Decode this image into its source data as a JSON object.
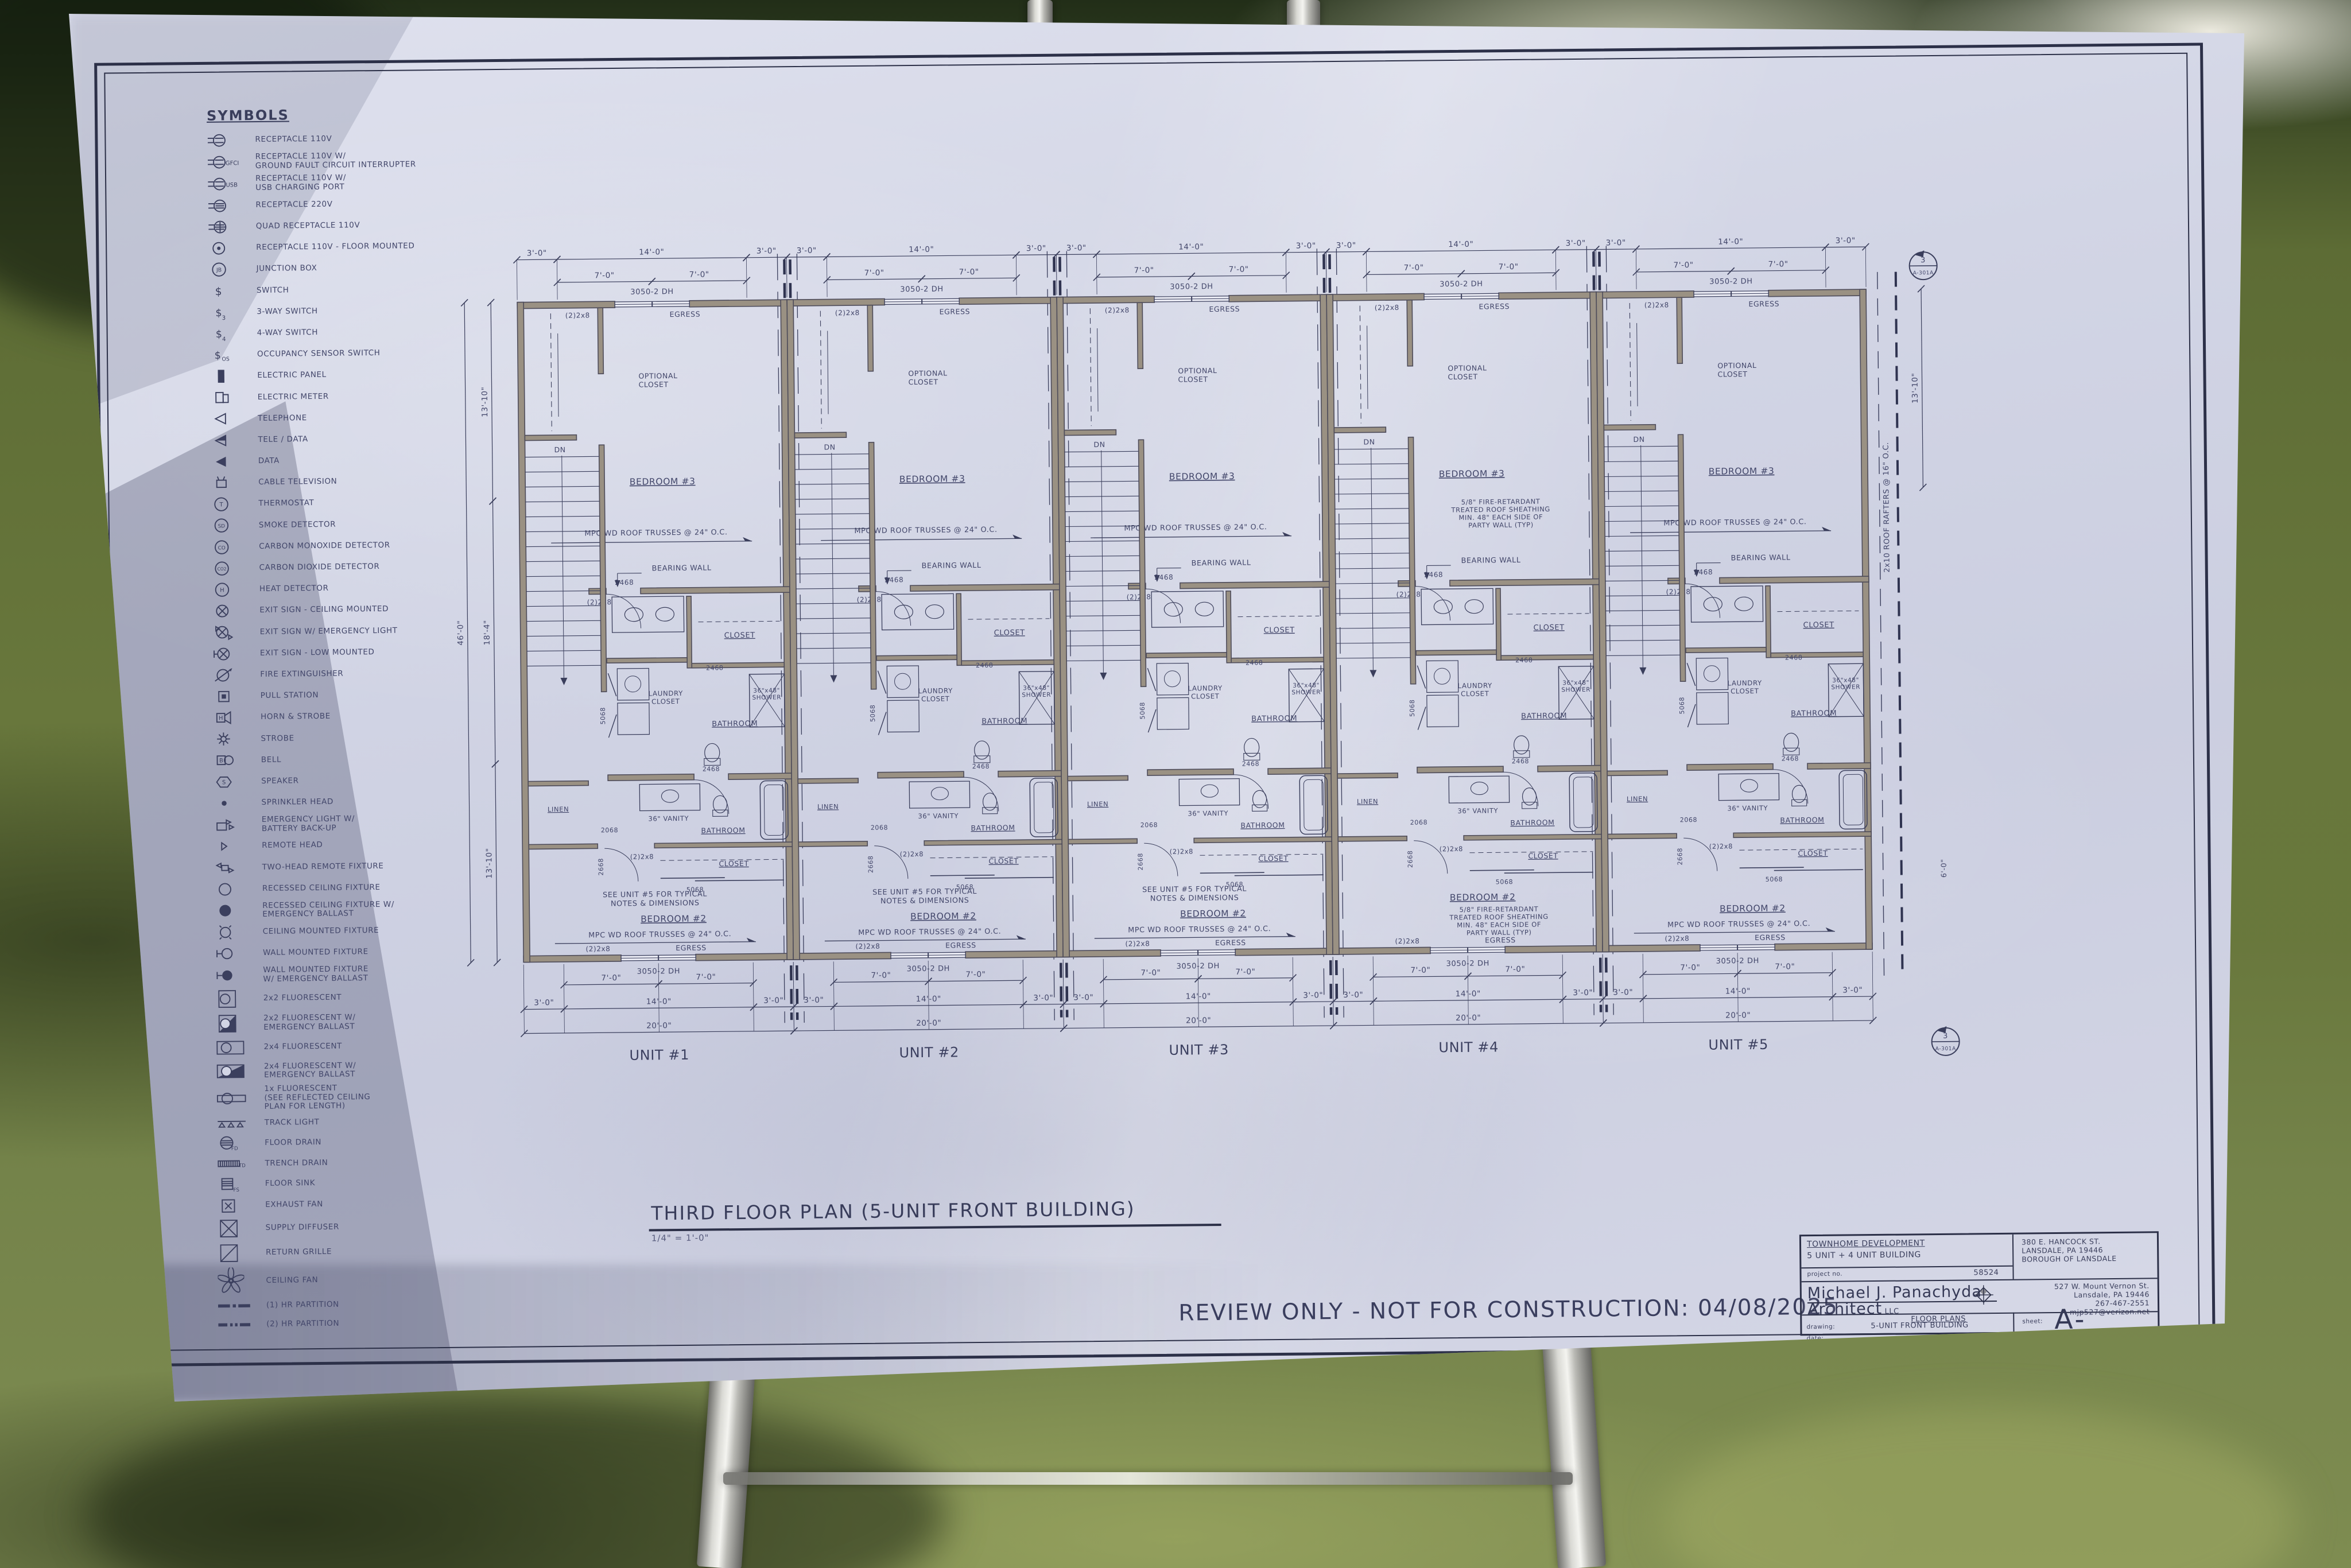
{
  "sheet": {
    "symbols_title": "SYMBOLS",
    "symbols": [
      {
        "icon": "receptacle-110v",
        "label": "RECEPTACLE 110V"
      },
      {
        "icon": "receptacle-gfci",
        "tag": "GFCI",
        "label": "RECEPTACLE 110V W/\nGROUND FAULT CIRCUIT INTERRUPTER"
      },
      {
        "icon": "receptacle-usb",
        "tag": "USB",
        "label": "RECEPTACLE 110V W/\nUSB CHARGING PORT"
      },
      {
        "icon": "receptacle-220v",
        "label": "RECEPTACLE 220V"
      },
      {
        "icon": "quad-receptacle",
        "label": "QUAD RECEPTACLE 110V"
      },
      {
        "icon": "receptacle-floor",
        "label": "RECEPTACLE 110V - FLOOR MOUNTED"
      },
      {
        "icon": "junction-box",
        "tag": "JB",
        "label": "JUNCTION BOX"
      },
      {
        "icon": "switch",
        "tag": "",
        "label": "SWITCH"
      },
      {
        "icon": "switch-3way",
        "tag": "3",
        "label": "3-WAY SWITCH"
      },
      {
        "icon": "switch-4way",
        "tag": "4",
        "label": "4-WAY SWITCH"
      },
      {
        "icon": "switch-occupancy",
        "tag": "OS",
        "label": "OCCUPANCY SENSOR SWITCH"
      },
      {
        "icon": "electric-panel",
        "label": "ELECTRIC PANEL"
      },
      {
        "icon": "electric-meter",
        "label": "ELECTRIC METER"
      },
      {
        "icon": "telephone",
        "label": "TELEPHONE"
      },
      {
        "icon": "tele-data",
        "label": "TELE / DATA"
      },
      {
        "icon": "data",
        "label": "DATA"
      },
      {
        "icon": "cable-television",
        "label": "CABLE TELEVISION"
      },
      {
        "icon": "thermostat",
        "tag": "T",
        "label": "THERMOSTAT"
      },
      {
        "icon": "smoke-detector",
        "tag": "SD",
        "label": "SMOKE DETECTOR"
      },
      {
        "icon": "carbon-monoxide-detector",
        "tag": "CO",
        "label": "CARBON MONOXIDE DETECTOR"
      },
      {
        "icon": "carbon-dioxide-detector",
        "tag": "CO2",
        "label": "CARBON DIOXIDE DETECTOR"
      },
      {
        "icon": "heat-detector",
        "tag": "H",
        "label": "HEAT DETECTOR"
      },
      {
        "icon": "exit-sign-ceiling",
        "label": "EXIT SIGN - CEILING MOUNTED"
      },
      {
        "icon": "exit-sign-emergency-light",
        "label": "EXIT SIGN W/ EMERGENCY LIGHT"
      },
      {
        "icon": "exit-sign-low",
        "label": "EXIT SIGN - LOW MOUNTED"
      },
      {
        "icon": "fire-extinguisher",
        "label": "FIRE EXTINGUISHER"
      },
      {
        "icon": "pull-station",
        "label": "PULL STATION"
      },
      {
        "icon": "horn-strobe",
        "tag": "H",
        "label": "HORN & STROBE"
      },
      {
        "icon": "strobe",
        "label": "STROBE"
      },
      {
        "icon": "bell",
        "tag": "B",
        "label": "BELL"
      },
      {
        "icon": "speaker",
        "tag": "S",
        "label": "SPEAKER"
      },
      {
        "icon": "sprinkler-head",
        "label": "SPRINKLER HEAD"
      },
      {
        "icon": "emergency-light-battery",
        "label": "EMERGENCY LIGHT W/\nBATTERY BACK-UP"
      },
      {
        "icon": "remote-head",
        "label": "REMOTE HEAD"
      },
      {
        "icon": "two-head-remote-fixture",
        "label": "TWO-HEAD REMOTE FIXTURE"
      },
      {
        "icon": "recessed-ceiling-fixture",
        "label": "RECESSED CEILING FIXTURE"
      },
      {
        "icon": "recessed-ceiling-fixture-em",
        "label": "RECESSED CEILING FIXTURE W/\nEMERGENCY BALLAST"
      },
      {
        "icon": "ceiling-mounted-fixture",
        "label": "CEILING MOUNTED FIXTURE"
      },
      {
        "icon": "wall-mounted-fixture",
        "label": "WALL MOUNTED FIXTURE"
      },
      {
        "icon": "wall-mounted-fixture-em",
        "label": "WALL MOUNTED FIXTURE\nW/ EMERGENCY BALLAST"
      },
      {
        "icon": "fluorescent-2x2",
        "label": "2x2 FLUORESCENT"
      },
      {
        "icon": "fluorescent-2x2-em",
        "label": "2x2 FLUORESCENT W/\nEMERGENCY BALLAST"
      },
      {
        "icon": "fluorescent-2x4",
        "label": "2x4 FLUORESCENT"
      },
      {
        "icon": "fluorescent-2x4-em",
        "label": "2x4 FLUORESCENT W/\nEMERGENCY BALLAST"
      },
      {
        "icon": "fluorescent-1x",
        "label": "1x FLUORESCENT\n(SEE REFLECTED CEILING\nPLAN FOR LENGTH)"
      },
      {
        "icon": "track-light",
        "label": "TRACK LIGHT"
      },
      {
        "icon": "floor-drain",
        "tag": "FD",
        "label": "FLOOR DRAIN"
      },
      {
        "icon": "trench-drain",
        "tag": "TD",
        "label": "TRENCH DRAIN"
      },
      {
        "icon": "floor-sink",
        "tag": "FS",
        "label": "FLOOR SINK"
      },
      {
        "icon": "exhaust-fan",
        "label": "EXHAUST FAN"
      },
      {
        "icon": "supply-diffuser",
        "label": "SUPPLY DIFFUSER"
      },
      {
        "icon": "return-grille",
        "label": "RETURN GRILLE"
      },
      {
        "icon": "ceiling-fan",
        "label": "CEILING FAN"
      },
      {
        "icon": "partition-1hr",
        "label": "(1) HR PARTITION"
      },
      {
        "icon": "partition-2hr",
        "label": "(2) HR PARTITION"
      }
    ],
    "plan": {
      "units": [
        "UNIT #1",
        "UNIT #2",
        "UNIT #3",
        "UNIT #4",
        "UNIT #5"
      ],
      "labels": {
        "bedroom3": "BEDROOM #3",
        "bedroom2": "BEDROOM #2",
        "optional_closet": "OPTIONAL\nCLOSET",
        "closet": "CLOSET",
        "laundry": "LAUNDRY\nCLOSET",
        "bathroom": "BATHROOM",
        "linen": "LINEN",
        "shower": "36\"x48\"\nSHOWER",
        "van60": "60\" VAN",
        "vanity36": "36\" VANITY",
        "egress": "EGRESS",
        "window": "3050-2 DH",
        "dn": "DN",
        "d2468": "2468",
        "d2668": "2668",
        "d2068": "2068",
        "d5068": "5068",
        "header": "(2)2x8"
      },
      "notes": {
        "truss": "MPC WD ROOF TRUSSES @ 24\" O.C.",
        "fire": "5/8\" FIRE-RETARDANT\nTREATED ROOF SHEATHING\nMIN. 48\" EACH SIDE OF\nPARTY WALL (TYP)",
        "see5": "SEE UNIT #5 FOR TYPICAL\nNOTES & DIMENSIONS",
        "rafters": "2x10 ROOF RAFTERS @ 16\" O.C.",
        "bearing": "BEARING WALL"
      },
      "dims": {
        "d3": "3'-0\"",
        "d7": "7'-0\"",
        "d14": "14'-0\"",
        "d20": "20'-0\"",
        "d46": "46'-0\"",
        "d18_4": "18'-4\"",
        "d13_10": "13'-10\"",
        "d6": "6'-0\""
      },
      "marker": {
        "num": "3",
        "sheet": "A-301A"
      }
    },
    "plan_title": "THIRD FLOOR PLAN (5-UNIT FRONT BUILDING)",
    "plan_scale": "1/4\" = 1'-0\"",
    "review_note": "REVIEW ONLY - NOT FOR CONSTRUCTION: 04/08/2025",
    "title_block": {
      "client_line1": "TOWNHOME DEVELOPMENT",
      "client_line2": "5 UNIT + 4 UNIT BUILDING",
      "project_label": "project no.",
      "project_no": "58524",
      "firm_line1": "Michael J. Panachyda",
      "firm_line2": "Architect",
      "firm_llc": "LLC",
      "site_addr1": "380 E. HANCOCK ST.",
      "site_addr2": "LANSDALE, PA 19446",
      "site_addr3": "BOROUGH OF LANSDALE",
      "firm_addr1": "527 W. Mount Vernon St.",
      "firm_addr2": "Lansdale, PA 19446",
      "firm_phone": "267-467-2551",
      "firm_email": "mjp527@verizon.net",
      "drawing_label": "drawing:",
      "drawing_title1": "FLOOR PLANS",
      "drawing_title2": "5-UNIT FRONT BUILDING",
      "date_label": "date:",
      "date_value": "00/00/2025",
      "sheet_label": "sheet:",
      "sheet_no": "A-103A"
    }
  }
}
